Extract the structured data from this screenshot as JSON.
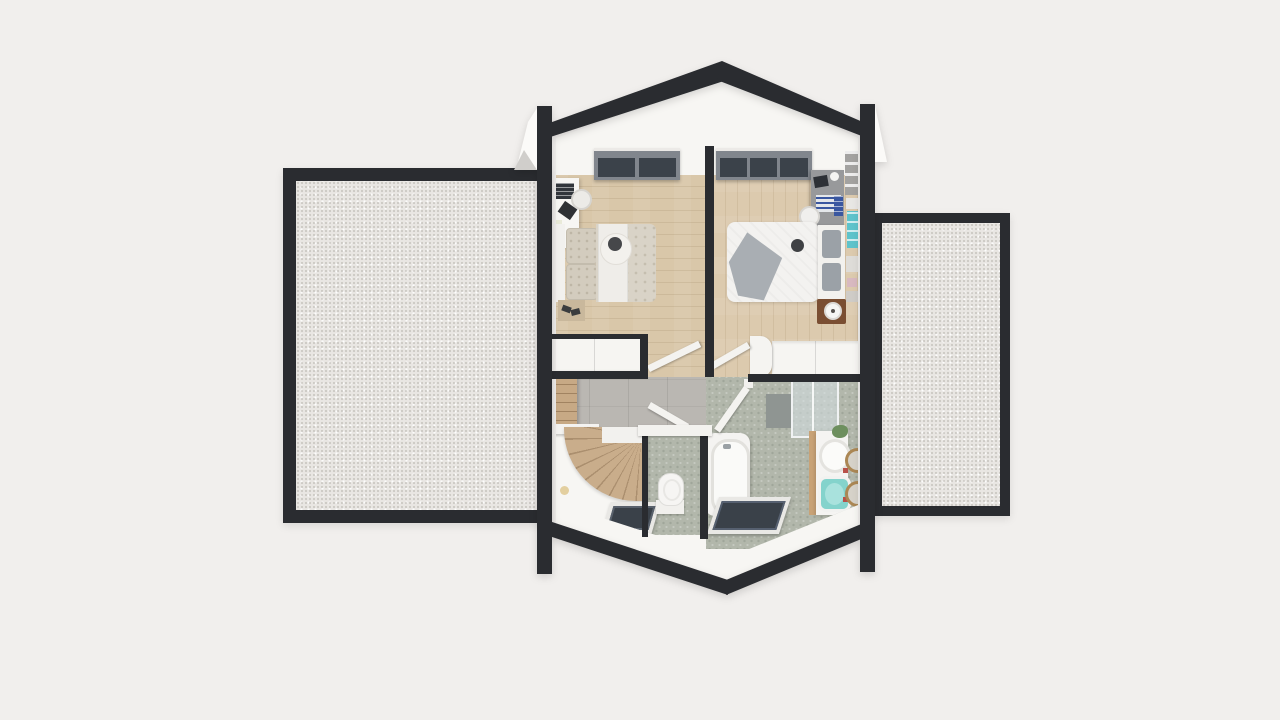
{
  "scene": {
    "type": "3d-floorplan-top-down-render",
    "floor": "attic level with gabled roof cut, flanked by two flat roof terraces",
    "areas": [
      {
        "name": "bedroom-left",
        "floor_finish": "light wood planks",
        "objects": [
          "sloped-roof-window",
          "desk",
          "monitor",
          "desk-chair",
          "bag",
          "tray",
          "double-bed",
          "headboard",
          "quilted-pillows",
          "duvet",
          "white-runner",
          "round-throw",
          "dark-throw-pillow",
          "bench-with-shoes",
          "built-in-wardrobe",
          "open-door"
        ]
      },
      {
        "name": "bedroom-right",
        "floor_finish": "light wood planks",
        "objects": [
          "sloped-roof-window",
          "desk",
          "laptop",
          "cup",
          "blue-striped-board",
          "desk-chair",
          "blue-books",
          "double-bed",
          "white-duvet",
          "gray-drape-blanket",
          "dark-throw-pillow",
          "headboard",
          "gray-pillows",
          "nightstand",
          "lamp",
          "wall-shelf",
          "teal-wall-art",
          "built-in-wardrobe",
          "open-door"
        ]
      },
      {
        "name": "landing",
        "floor_finish": "gray tiles + white slope",
        "objects": [
          "bookshelf",
          "handrail",
          "winder-staircase",
          "slope-roof-window",
          "floor-lamp"
        ]
      },
      {
        "name": "wc",
        "floor_finish": "sage hex tile",
        "objects": [
          "toilet",
          "open-door",
          "white-capped-wall"
        ]
      },
      {
        "name": "bathroom",
        "floor_finish": "sage hex tile",
        "objects": [
          "bathtub",
          "open-door",
          "shower-enclosure",
          "shower-wall-panel",
          "vanity",
          "white-round-sink",
          "teal-square-sink",
          "plant",
          "gold-round-mirror",
          "gold-round-mirror",
          "slope-roof-window"
        ]
      },
      {
        "name": "terrace-left",
        "floor_finish": "white gravel flat roof with dark parapet",
        "objects": []
      },
      {
        "name": "terrace-right",
        "floor_finish": "white gravel flat roof with dark parapet",
        "objects": []
      }
    ],
    "structure_elements": [
      "roof-ridge-left",
      "roof-ridge-right",
      "eaves-left",
      "eaves-right",
      "corner-post-left",
      "corner-post-right",
      "central-partition-wall",
      "gable-wedge"
    ]
  },
  "colors": {
    "bg": "#f1efed",
    "wall": "#2a2c30",
    "terrace_fill": "#e9e6e3",
    "interior": "#f7f6f3",
    "wood_left": "#d9c7a9",
    "wood_right": "#dccaae",
    "tile_gray": "#bab7b2",
    "tile_sage": "#b2b7ab",
    "stair_wood": "#c9ad8b",
    "window_pane": "#3b424a",
    "window_frame": "#81868d",
    "gold": "#ab8754",
    "sink_teal": "#84d3cc",
    "art_teal": "#5ec3cb",
    "blanket_gray": "#a9aeb3",
    "nightstand": "#7a4e32",
    "book_blue": "#3a57a0",
    "plant_green": "#6d8f5e"
  }
}
